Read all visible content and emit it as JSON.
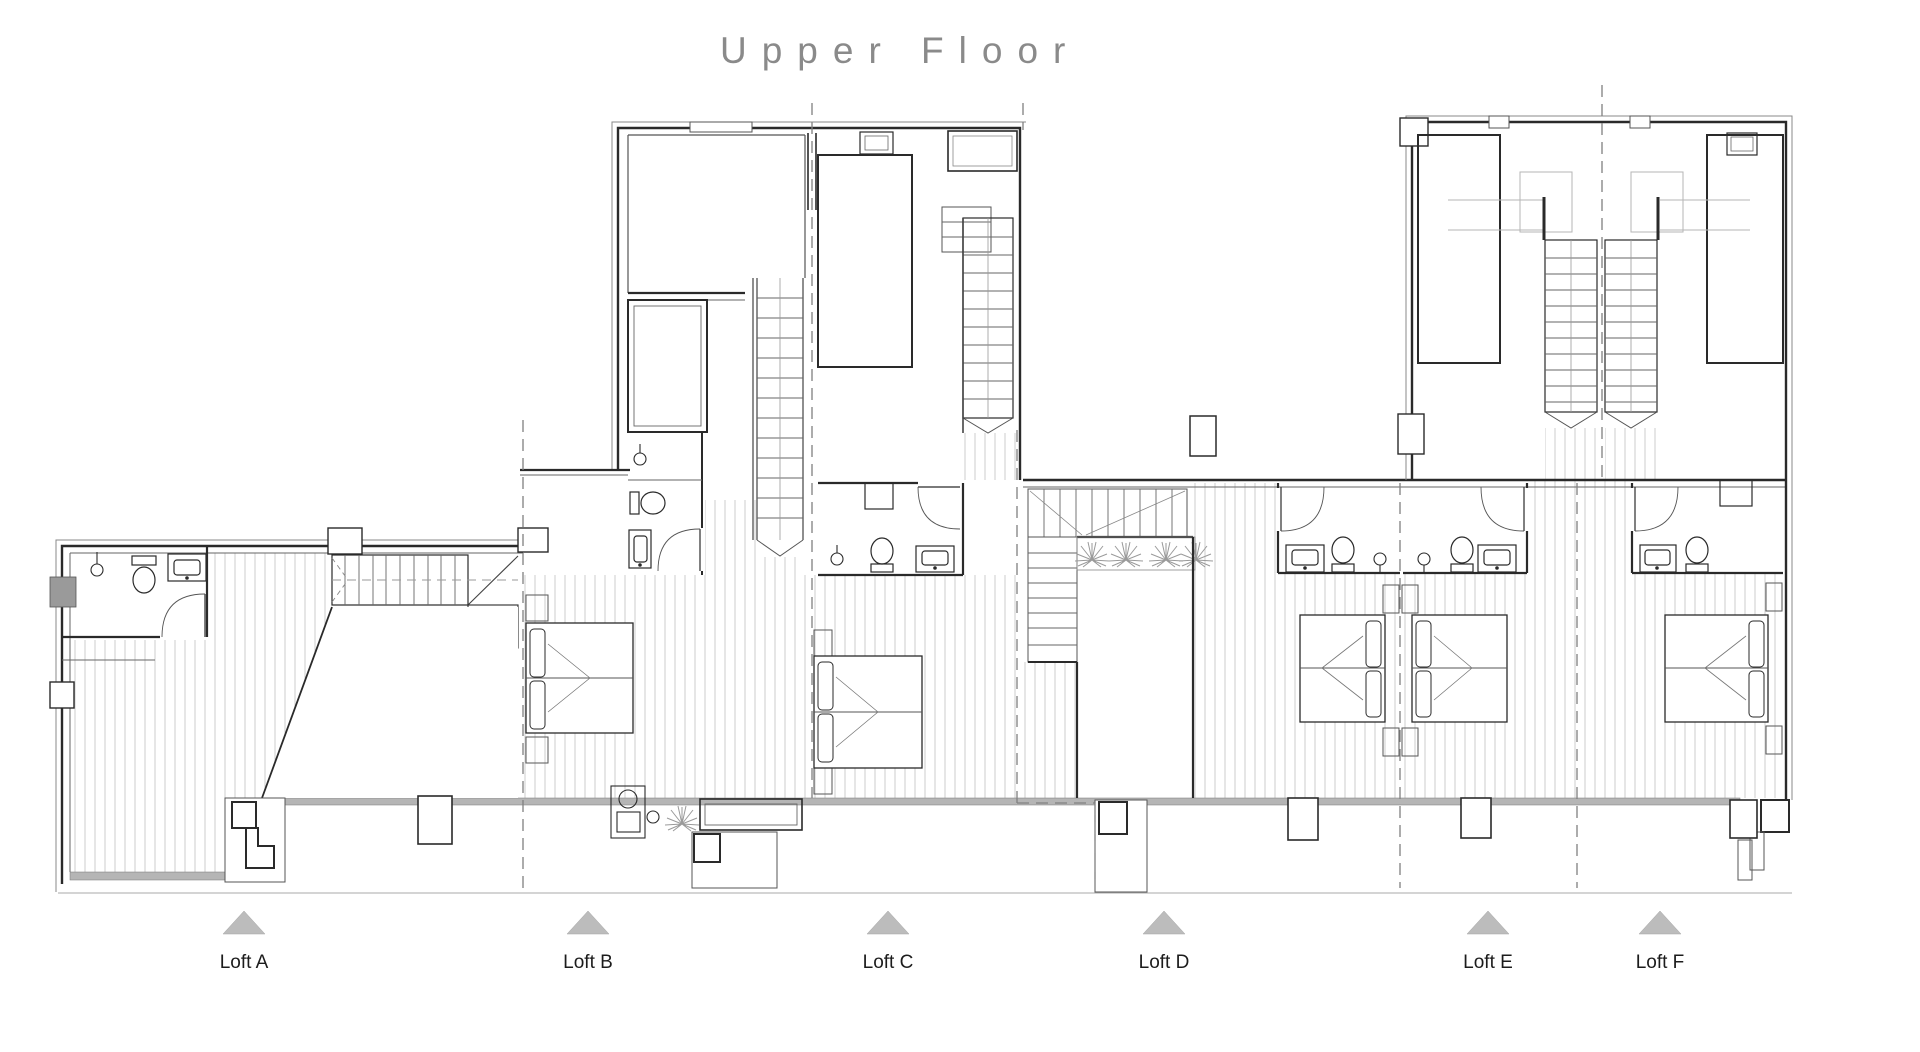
{
  "title": "Upper Floor",
  "lofts": [
    {
      "id": "A",
      "label": "Loft A"
    },
    {
      "id": "B",
      "label": "Loft B"
    },
    {
      "id": "C",
      "label": "Loft C"
    },
    {
      "id": "D",
      "label": "Loft D"
    },
    {
      "id": "E",
      "label": "Loft E"
    },
    {
      "id": "F",
      "label": "Loft F"
    }
  ],
  "colors": {
    "background": "#ffffff",
    "wall_line": "#2a2a2a",
    "thin_line": "#666666",
    "hatch_line": "#cdcdcd",
    "divider_dash": "#808080",
    "marker_triangle": "#bcbcbc",
    "title_gray": "#8a8a8a",
    "terrace_band": "#b5b5b5",
    "plant_gray": "#9a9a9a"
  },
  "icons": {
    "marker": "loft-marker-triangle",
    "bed": "bed-icon",
    "toilet": "toilet-icon",
    "sink": "sink-icon",
    "shower": "shower-icon",
    "stair": "stair-icon",
    "door": "door-arc-icon",
    "plant": "plant-icon"
  }
}
